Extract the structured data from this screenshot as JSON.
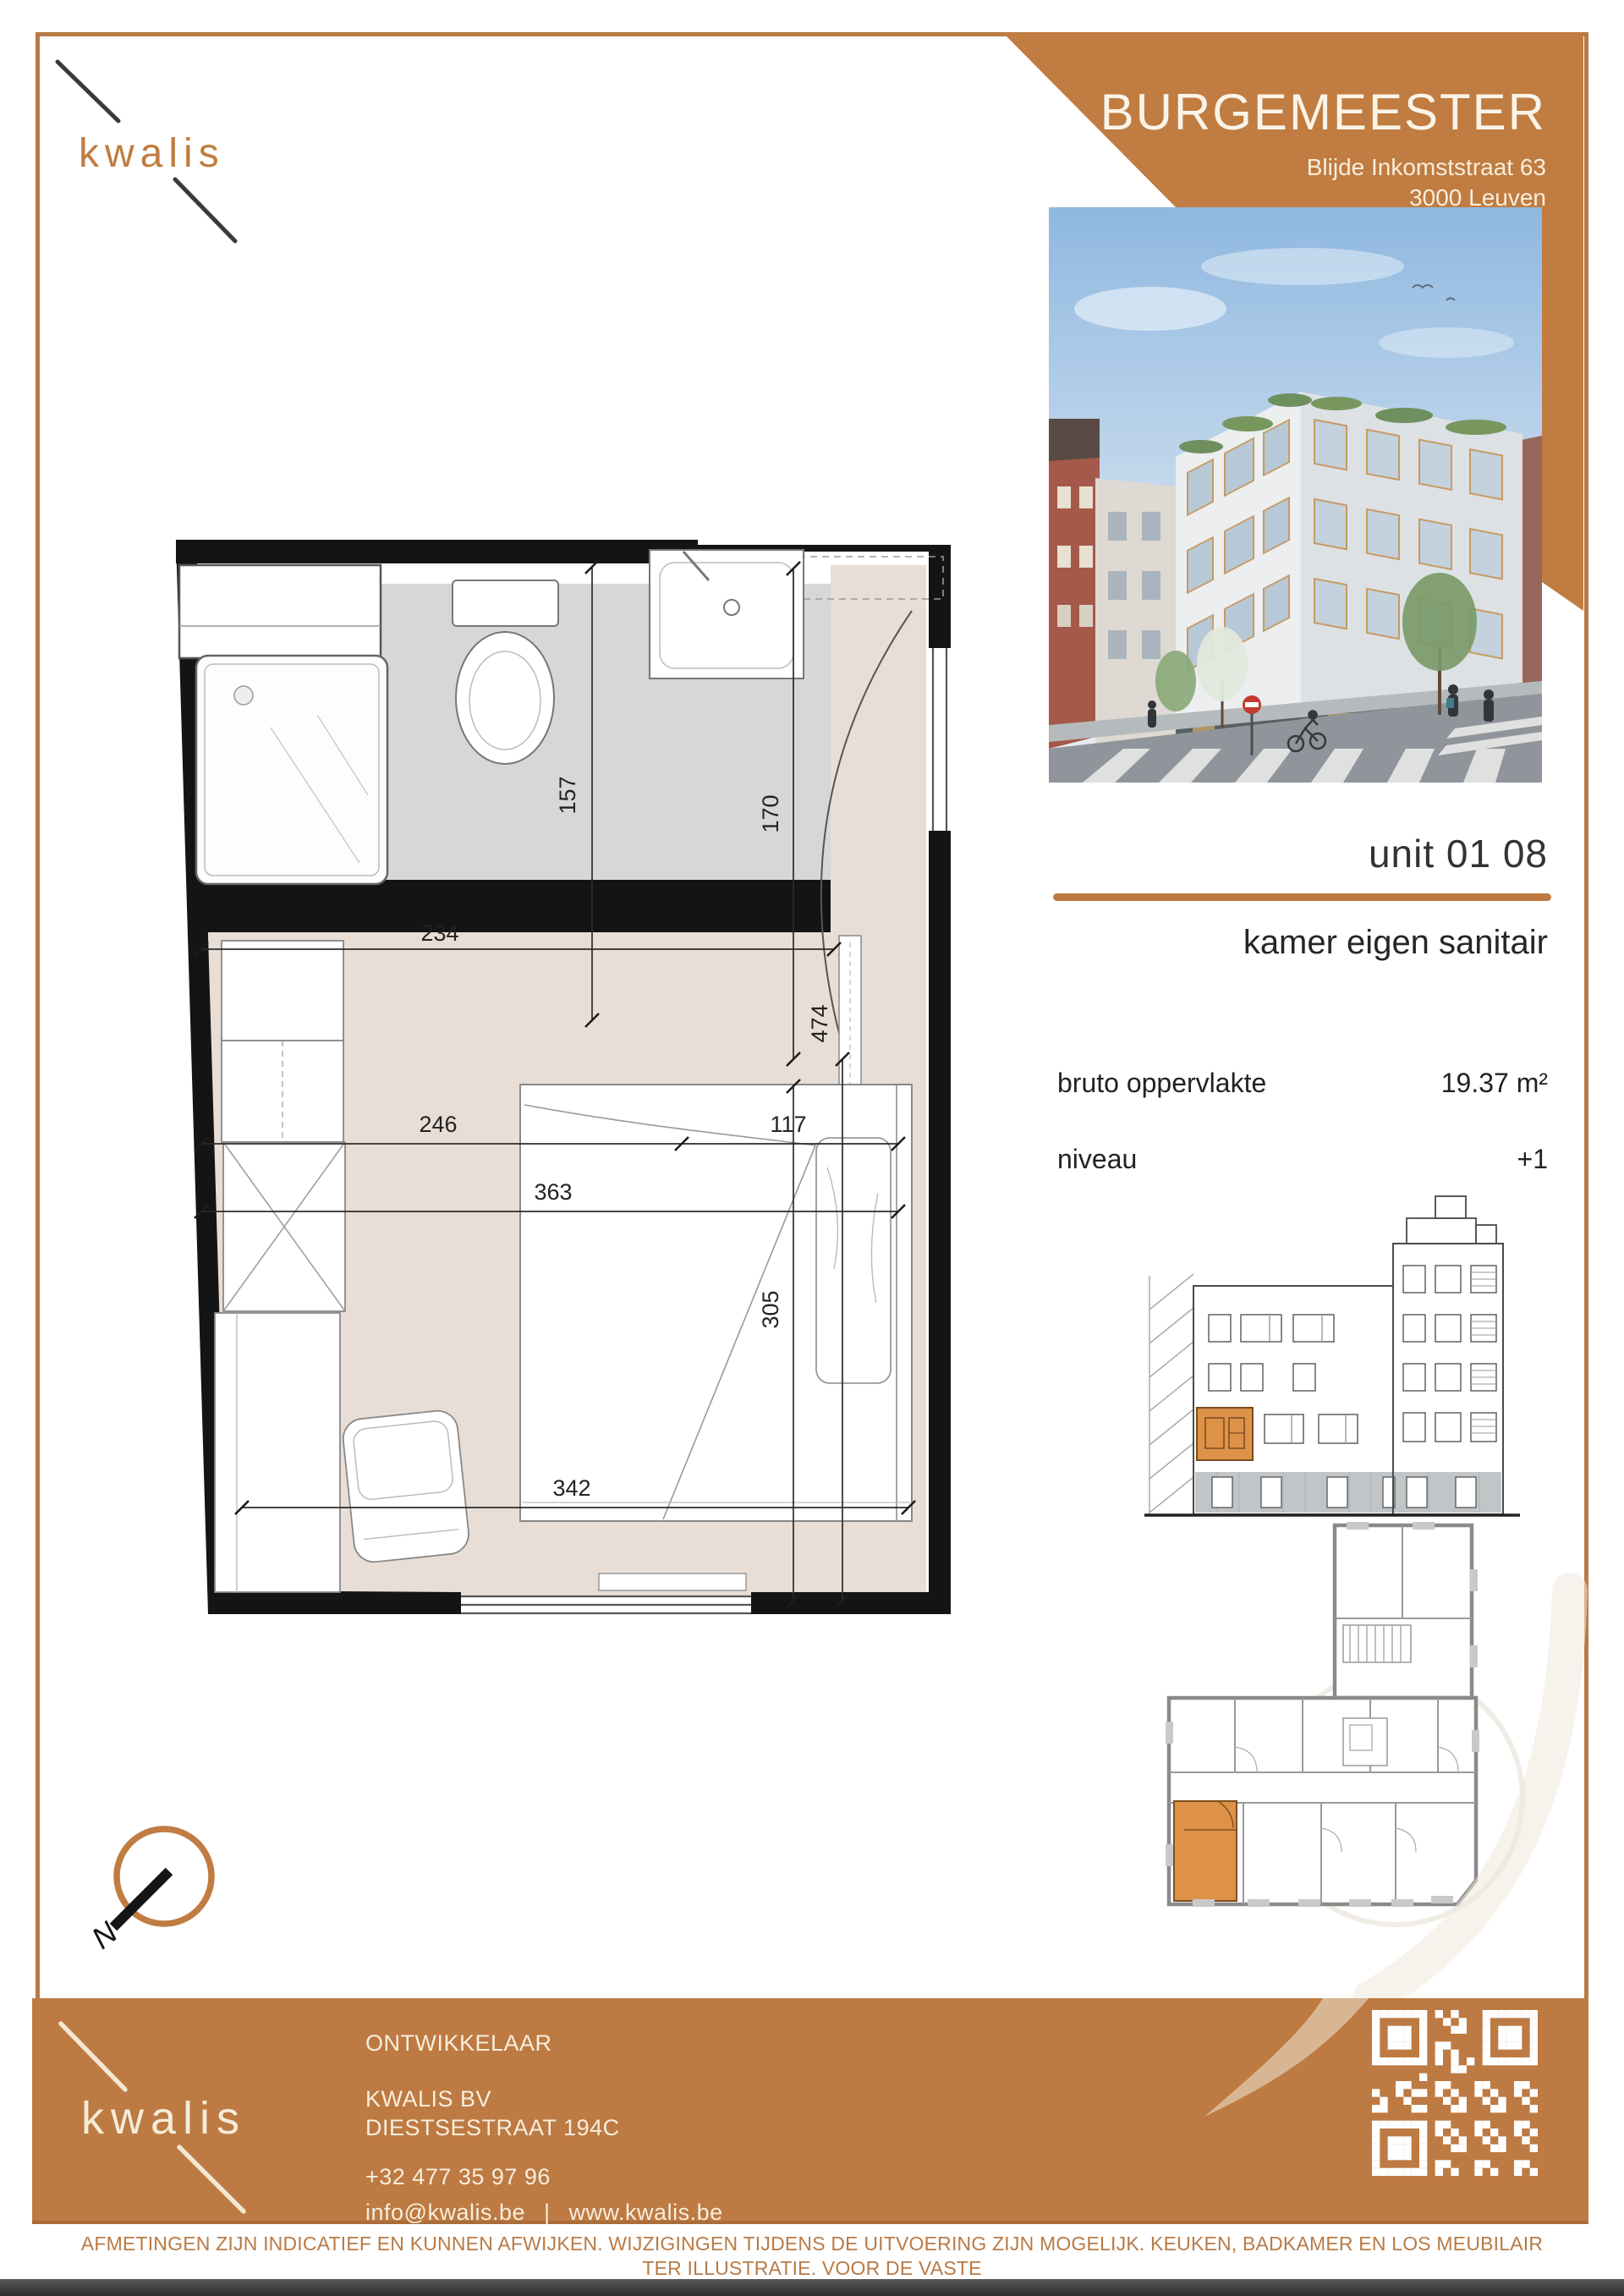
{
  "brand": {
    "logo_text": "kwalis"
  },
  "header": {
    "title": "BURGEMEESTER",
    "address_line1": "Blijde Inkomststraat 63",
    "address_line2": "3000 Leuven"
  },
  "unit": {
    "id": "unit 01 08",
    "type": "kamer eigen sanitair",
    "area_label": "bruto oppervlakte",
    "area_value": "19.37 m²",
    "level_label": "niveau",
    "level_value": "+1"
  },
  "floorplan": {
    "dims": {
      "bath_width": "234",
      "bath_depth": "157",
      "entry_depth": "170",
      "room_width_left": "246",
      "room_width_right": "117",
      "room_width_total": "363",
      "room_depth_total": "474",
      "bed_zone_depth": "305",
      "room_width_bottom": "342"
    }
  },
  "compass": {
    "north_label": "N"
  },
  "footer": {
    "developer_label": "ONTWIKKELAAR",
    "company": "KWALIS BV",
    "address": "DIESTSESTRAAT 194C",
    "phone": "+32 477 35 97 96",
    "email": "info@kwalis.be",
    "separator": "|",
    "website": "www.kwalis.be"
  },
  "disclaimer": {
    "line1": "AFMETINGEN ZIJN INDICATIEF EN KUNNEN AFWIJKEN. WIJZIGINGEN TIJDENS DE UITVOERING ZIJN MOGELIJK. KEUKEN, BADKAMER EN LOS MEUBILAIR TER ILLUSTRATIE. VOOR DE VASTE",
    "line2": "INRICHTING GELDT DE BESCHRIJVING IN HET LASTENBOEK. ER KUNNEN GEEN RECHTEN AAN DIT PLAN ONTLEEND WORDEN."
  }
}
